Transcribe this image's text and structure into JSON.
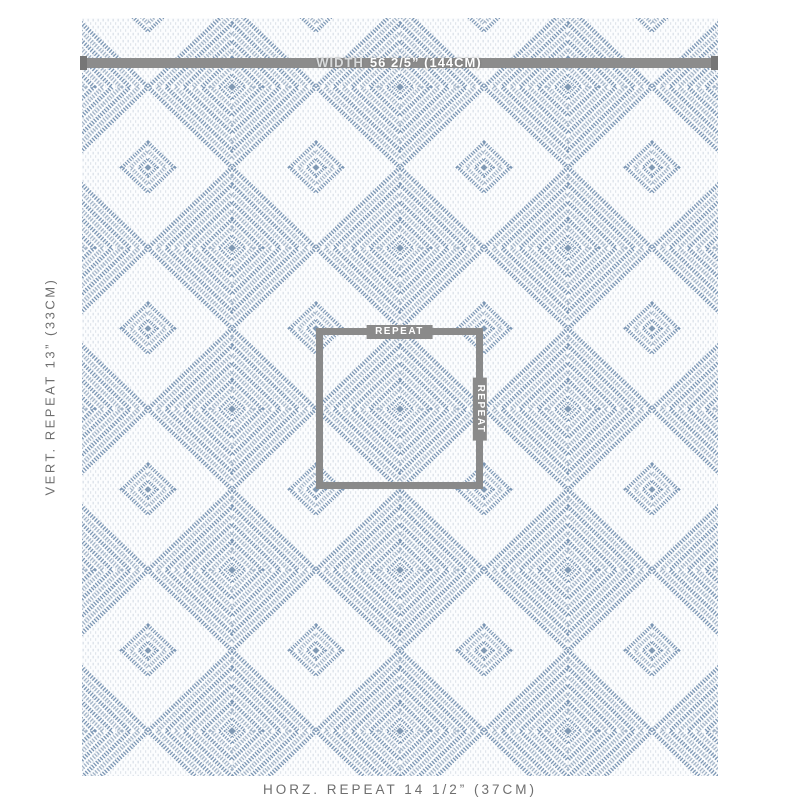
{
  "product_image": {
    "width_bar": {
      "prefix": "WIDTH",
      "value": "56 2/5” (144CM)"
    },
    "repeat_box": {
      "top_label": "REPEAT",
      "side_label": "REPEAT"
    },
    "vert_repeat_label": "VERT. REPEAT 13” (33CM)",
    "horz_repeat_label": "HORZ. REPEAT 14 1/2” (37CM)",
    "colors": {
      "fabric_blue": "#7b96b4",
      "fabric_blue_light": "#a2b4c8",
      "fabric_ground": "#fcfdfe",
      "measure_bar_gray": "#8c8c8c",
      "measure_cap_gray": "#767676",
      "repeat_box_gray": "#8a8a8a",
      "label_text_gray": "#6f6f6f",
      "bar_text_white": "#ffffff"
    }
  }
}
